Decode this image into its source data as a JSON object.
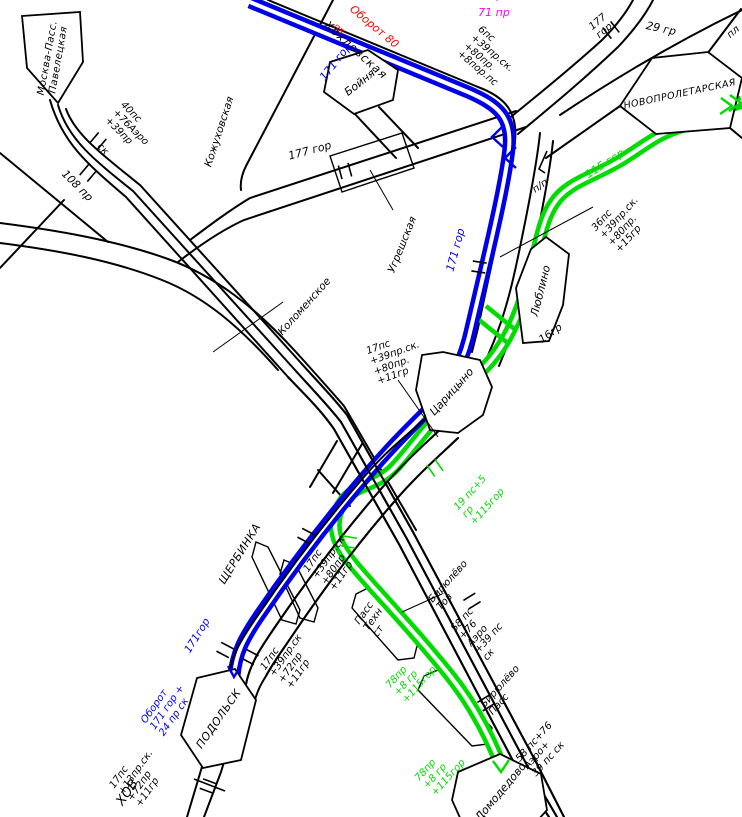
{
  "colors": {
    "route_blue": "#0000E6",
    "route_green": "#00DC00",
    "accent_red": "#FF0000",
    "accent_magenta": "#FF00FF",
    "track_black": "#000000",
    "background": "#FFFFFF"
  },
  "stations": [
    {
      "id": "moskva-pass-paveletskaya",
      "name": "Москва-Пасс.\nПавелецкая"
    },
    {
      "id": "boynya",
      "name": "Бойня"
    },
    {
      "id": "novoproletarskaya",
      "name": "НОВОПРОЛЕТАРСКАЯ"
    },
    {
      "id": "lyublino",
      "name": "Люблино"
    },
    {
      "id": "tsaritsyno",
      "name": "Царицыно"
    },
    {
      "id": "podolsk",
      "name": "ПОДОЛЬСК"
    },
    {
      "id": "domodedovo-partial",
      "name": "Домодедово"
    },
    {
      "id": "shcherbinka",
      "name": "ЩЕРБИНКА"
    },
    {
      "id": "khokhlovskaya",
      "name": "Хохловская"
    },
    {
      "id": "kozhukhovskaya",
      "name": "Кожуховская"
    },
    {
      "id": "ugreshskaya",
      "name": "Угрешская"
    },
    {
      "id": "kolomenskoye",
      "name": "Коломенское"
    },
    {
      "id": "birulevo-tov",
      "name": "Бирюлёво\nТов"
    },
    {
      "id": "birulevo-pass",
      "name": "Бирюлёво\nПасс"
    },
    {
      "id": "pass-tehn-st",
      "name": "Пасс\nТехн\nст"
    },
    {
      "id": "chekhov-partial",
      "name": "ХОВ"
    }
  ],
  "route_labels": [
    {
      "id": "oborot-80",
      "text": "Оборот 80",
      "color": "red"
    },
    {
      "id": "red-fragment",
      "text": "пв",
      "color": "red"
    },
    {
      "id": "magenta-fragment",
      "text": "гор +",
      "color": "magenta"
    },
    {
      "id": "magenta-71pr",
      "text": "71 пр",
      "color": "magenta"
    },
    {
      "id": "blue-171-top",
      "text": "171 гор",
      "color": "blue"
    },
    {
      "id": "blue-171-mid",
      "text": "171 гор",
      "color": "blue"
    },
    {
      "id": "blue-171-podolsk",
      "text": "171гор",
      "color": "blue"
    },
    {
      "id": "blue-oborot-171",
      "text": "Оборот\n171 гор +\n24 пр ск",
      "color": "blue"
    },
    {
      "id": "green-115-top",
      "text": "115 гор",
      "color": "green"
    },
    {
      "id": "green-19ps",
      "text": "19 пс+5\nгр\n+115гор",
      "color": "green"
    },
    {
      "id": "green-78pr-1",
      "text": "78пр\n+8 гр\n+115гор",
      "color": "green"
    },
    {
      "id": "green-78pr-2",
      "text": "78пр\n+8 гр\n+115гор",
      "color": "green"
    }
  ],
  "track_labels": [
    {
      "id": "6ps",
      "text": "6пс\n+39пр.ск.\n+80пр.\n+8пор.пс"
    },
    {
      "id": "29gr",
      "text": "29 гр"
    },
    {
      "id": "pl",
      "text": "пл"
    },
    {
      "id": "177-gor-top",
      "text": "177\nгор"
    },
    {
      "id": "177-gor-left",
      "text": "177 гор"
    },
    {
      "id": "40ps",
      "text": "40пс\n+76Аэро\n+39пр"
    },
    {
      "id": "sk",
      "text": "ск"
    },
    {
      "id": "108pr",
      "text": "108 пр"
    },
    {
      "id": "pp",
      "text": "п/п"
    },
    {
      "id": "36ps",
      "text": "36пс\n+39пр.ск.\n+80пр.\n+15гр"
    },
    {
      "id": "16gr",
      "text": "16гр"
    },
    {
      "id": "17ps-tsaritsyno",
      "text": "17пс\n+39пр.ск.\n+80пр.\n+11гр"
    },
    {
      "id": "17ps-crossing",
      "text": "17пс\n+39пр.ск\n+80пр\n+11гр"
    },
    {
      "id": "58ps-birulevo",
      "text": "58 пс\n+76\nАэро\n+39 пс\nск"
    },
    {
      "id": "58ps-domodedovo",
      "text": "58 пс+76\nАэро+\n39 пс ск"
    },
    {
      "id": "17ps-podolsk",
      "text": "17пс\n+39пр.ск\n+72пр\n+11гр"
    },
    {
      "id": "17ps-chekhov",
      "text": "17пс\n+13пр.ск.\n+72пр\n+11гр"
    }
  ]
}
